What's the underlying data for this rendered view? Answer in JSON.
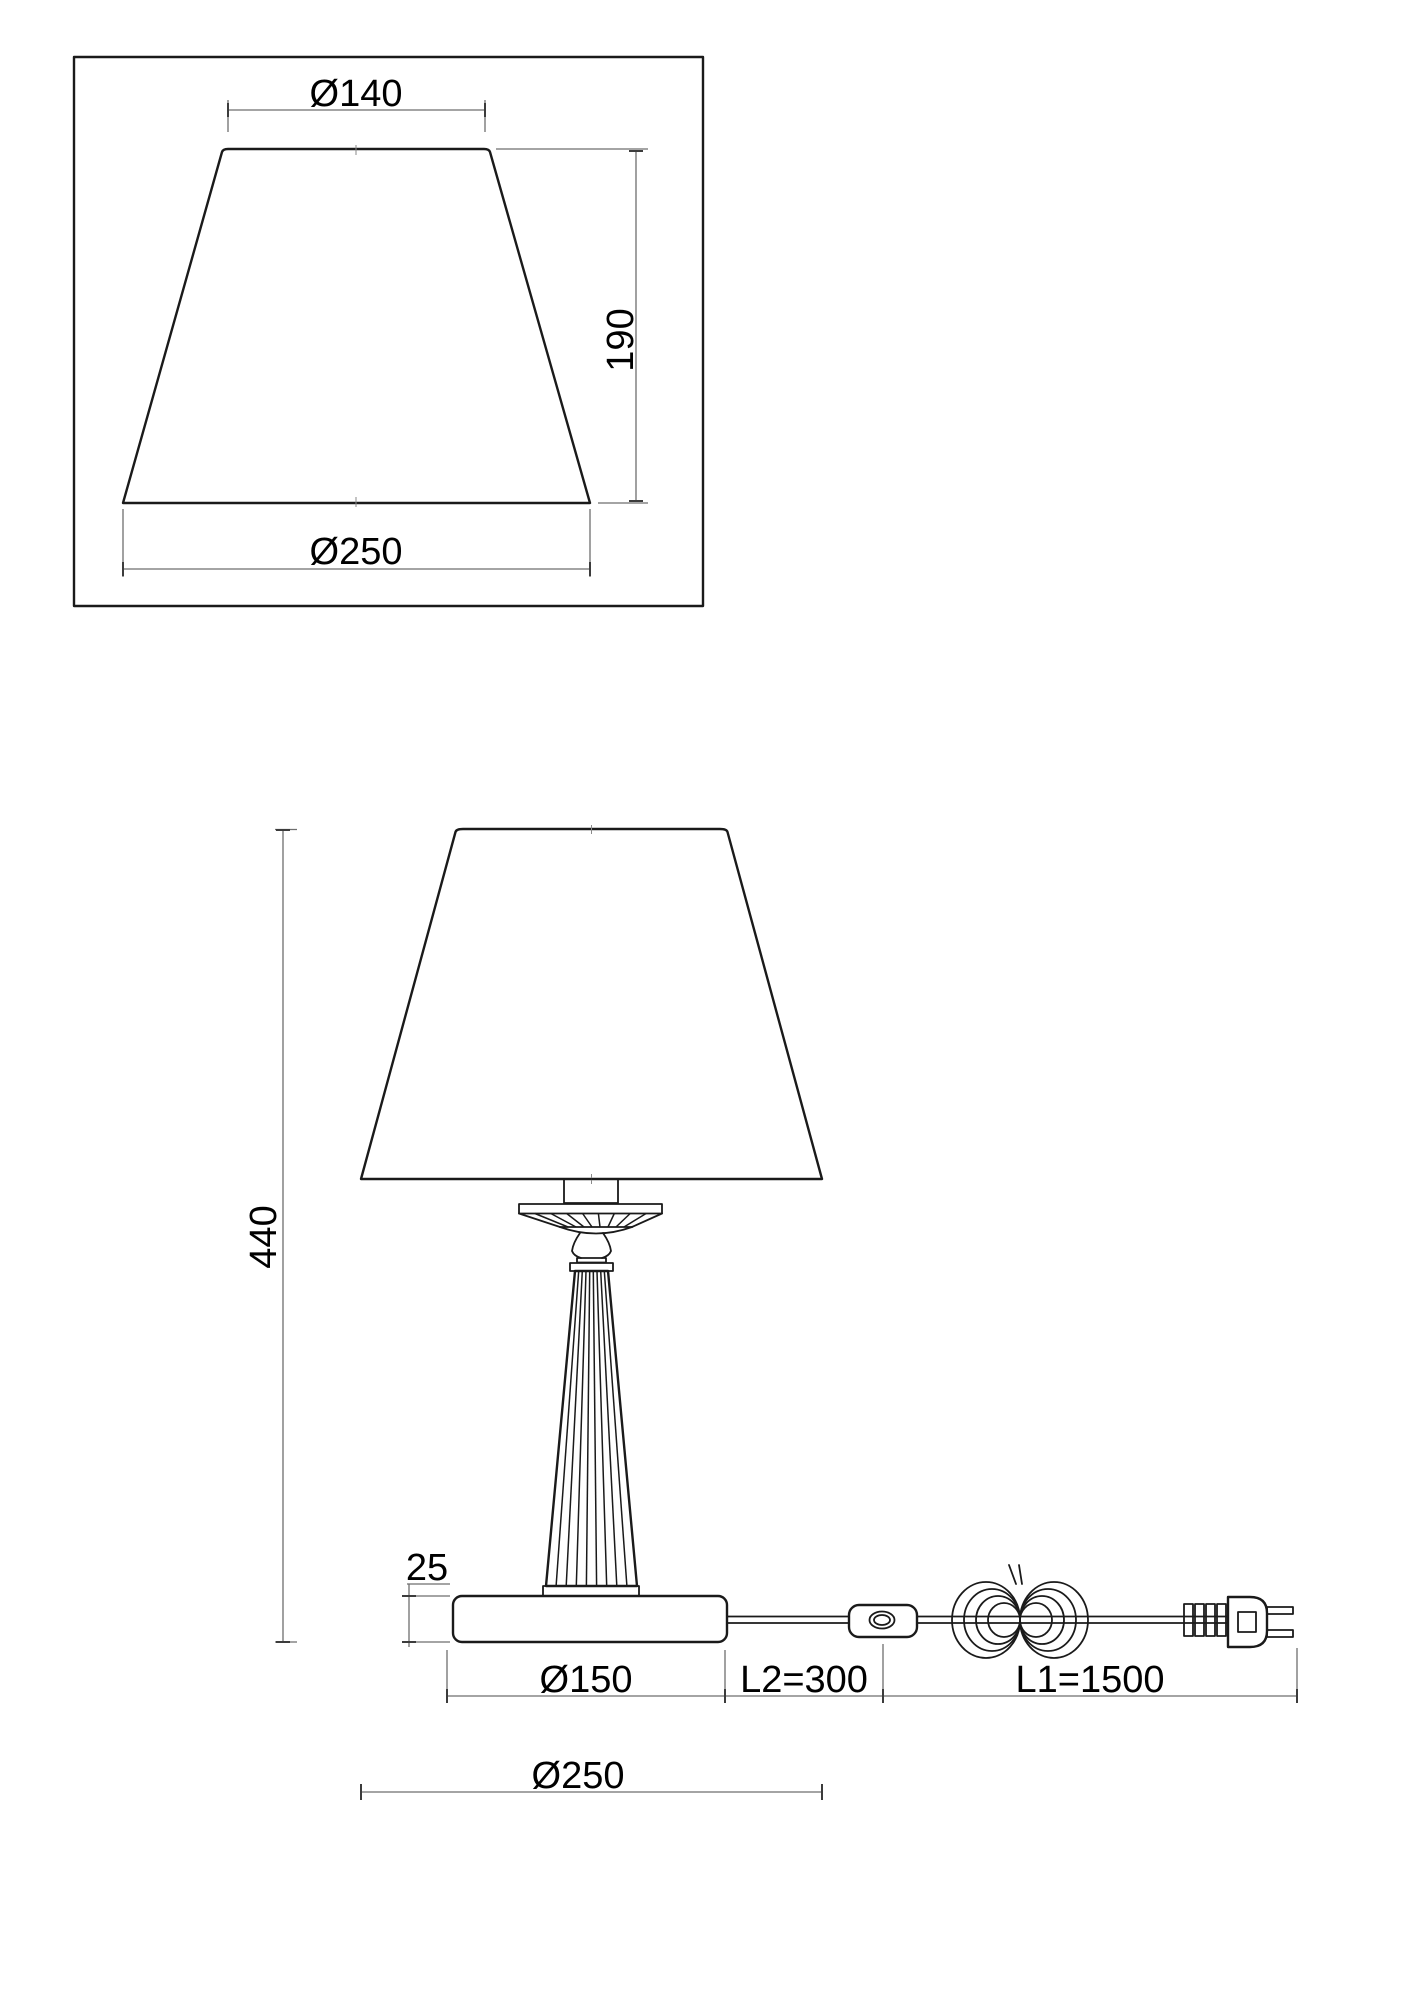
{
  "drawing": {
    "kind": "table-lamp technical dimension drawing",
    "background": "#ffffff",
    "line_color": "#1a1a1a",
    "dimension_line_color": "#6e6e6e",
    "text_color": "#000000"
  },
  "detail_view": {
    "description": "lampshade detail in rectangular frame",
    "top_diameter_label": "Ø140",
    "height_label": "190",
    "bottom_diameter_label": "Ø250"
  },
  "front_view": {
    "description": "full lamp elevation with cord, switch and plug",
    "total_height_label": "440",
    "base_height_label": "25",
    "base_diameter_label": "Ø150",
    "switch_cord_label": "L2=300",
    "plug_cord_label": "L1=1500",
    "shade_diameter_label": "Ø250"
  }
}
